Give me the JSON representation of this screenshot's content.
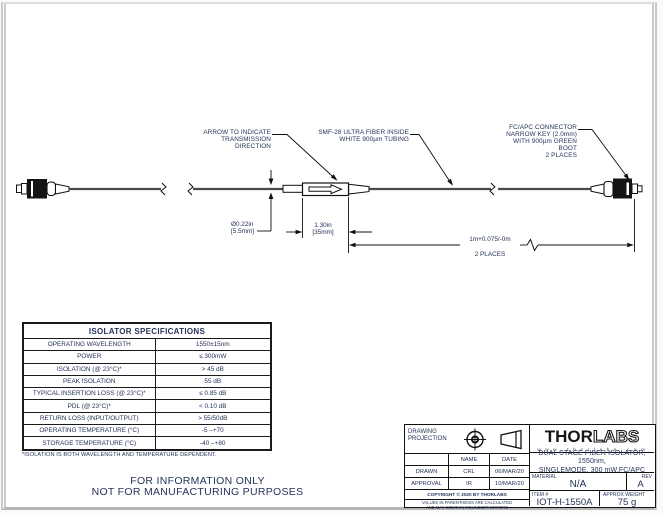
{
  "callouts": {
    "transmission_arrow": "ARROW TO INDICATE\nTRANSMISSION DIRECTION",
    "fiber_tubing": "SMF-28 ULTRA FIBER INSIDE\nWHITE 900µm TUBING",
    "connector": "FC/APC CONNECTOR\nNARROW KEY (2.0mm)\nWITH 900µm GREEN BOOT\n2 PLACES"
  },
  "dimensions": {
    "diameter": "Ø0.22in\n[5.5mm]",
    "body_length": "1.30in\n[35mm]",
    "fiber_length": "1m+0.075/-0m",
    "fiber_length_note": "2 PLACES"
  },
  "spec_table": {
    "title": "ISOLATOR SPECIFICATIONS",
    "rows": [
      {
        "label": "OPERATING WAVELENGTH",
        "value": "1550±15nm"
      },
      {
        "label": "POWER",
        "value": "≤ 300mW"
      },
      {
        "label": "ISOLATION (@ 23°C)*",
        "value": "> 45 dB"
      },
      {
        "label": "PEAK ISOLATION",
        "value": "55 dB"
      },
      {
        "label": "TYPICAL INSERTION LOSS (@ 23°C)*",
        "value": "≤ 0.85 dB"
      },
      {
        "label": "PDL (@ 23°C)*",
        "value": "< 0.10 dB"
      },
      {
        "label": "RETURN LOSS (INPUT/OUTPUT)",
        "value": "> 55/50dB"
      },
      {
        "label": "OPERATING TEMPERATURE (°C)",
        "value": "-5 –+70"
      },
      {
        "label": "STORAGE TEMPERATURE (°C)",
        "value": "-40 –+80"
      }
    ],
    "footnote": "*ISOLATION IS BOTH WAVELENGTH AND TEMPERATURE DEPENDENT."
  },
  "info_notice": "FOR INFORMATION ONLY\nNOT FOR MANUFACTURING PURPOSES",
  "title_block": {
    "projection_label": "DRAWING\nPROJECTION",
    "name_header": "NAME",
    "date_header": "DATE",
    "drawn_label": "DRAWN",
    "drawn_name": "CRL",
    "drawn_date": "06/MAR/20",
    "approval_label": "APPROVAL",
    "approval_name": "IR",
    "approval_date": "10/MAR/20",
    "copyright": "COPYRIGHT © 2020 BY THORLABS",
    "disclaimer": "VALUES IN PARENTHESIS ARE CALCULATED\nAND MAY CONTAIN ROUNDOFF ERRORS",
    "logo_thor": "THOR",
    "logo_labs": "LABS",
    "website": "w w w . t h o r l a b s . c o m",
    "title": "DUAL STAGE FIBER ISOLATOR, 1550nm,\nSINGLEMODE, 300 mW,FC/APC",
    "material_label": "MATERIAL",
    "material_value": "N/A",
    "rev_label": "REV",
    "rev_value": "A",
    "item_label": "ITEM #",
    "item_value": "IOT-H-1550A",
    "weight_label": "APPROX WEIGHT",
    "weight_value": "75 g"
  },
  "colors": {
    "text": "#26335a",
    "line": "#111111",
    "fiber": "#4a4a4a"
  }
}
